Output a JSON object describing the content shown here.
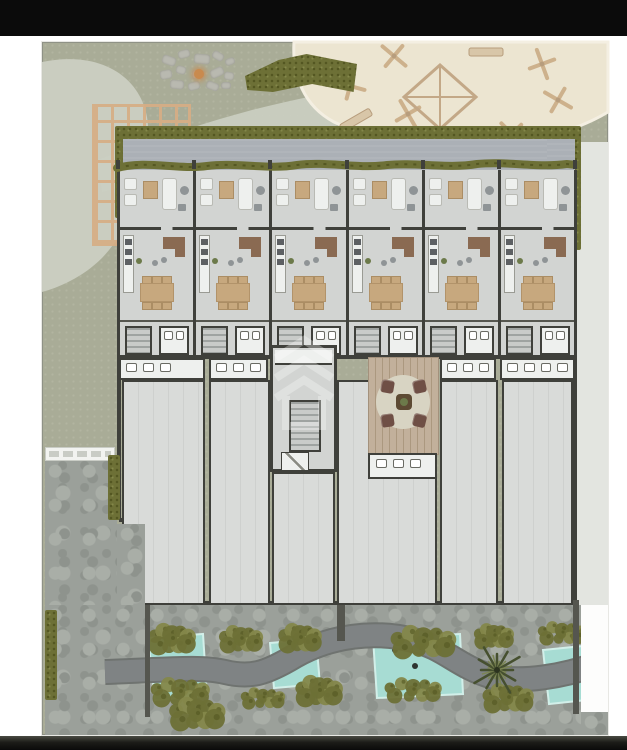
{
  "meta": {
    "description": "Rendered architectural ground-floor site plan: six row-house units with furnished interiors, a central stair core, courtyard deck with seating, large lower flex rooms, playground sand area, pergola, fire pit, hedges, stone paving and a water garden. No visible text; black letterbox bars top and bottom."
  },
  "palette": {
    "letterbox": "#0b0b0b",
    "page_bg": "#ffffff",
    "ground": "#a9ac97",
    "ground_dot": "#b2b5a0",
    "path_light": "#cbcfc2",
    "sand": "#ece5d1",
    "sand_edge": "#f4efe2",
    "equipment": "#cdb18c",
    "stone": "#b9b9b0",
    "fire": "#c98a4e",
    "hedge": "#6d7036",
    "hedge_dark": "#545722",
    "hedge_light": "#84874a",
    "pergola": "#d7ae85",
    "roof": "#abb0b6",
    "floor": "#d2d4d2",
    "floor_lower": "#d9dbd9",
    "wall": "#3f403b",
    "wall_soft": "#55564f",
    "furn_white": "#eef0ee",
    "furn_gray": "#8f9496",
    "wood": "#c7a87e",
    "wood_dark": "#8a6a52",
    "deck": "#c2b09b",
    "deck_line": "#ab987f",
    "rug": "#d8d4c3",
    "chair": "#6f4f45",
    "stone_paving": "#9ba09a",
    "paving_dark": "#8e938d",
    "paving_light": "#a9aea7",
    "water": "#a7dcd3",
    "water_edge": "#d2efe9",
    "garden_path": "#7f8384",
    "garden_path_edge": "#6f7370",
    "palm": "#46502f",
    "palm_light": "#7c8653",
    "pale_strip": "#e3e5e0",
    "walkway": "#f2f3f0",
    "watermark": "rgba(255,255,255,0.3)"
  },
  "building": {
    "upper_units": 6,
    "hedge_posts": 7,
    "lower_rooms": [
      {
        "x": 80,
        "y": 338,
        "w": 83,
        "h": 225
      },
      {
        "x": 167,
        "y": 338,
        "w": 61,
        "h": 225
      },
      {
        "x": 230,
        "y": 430,
        "w": 63,
        "h": 133
      },
      {
        "x": 295,
        "y": 338,
        "w": 100,
        "h": 225
      },
      {
        "x": 398,
        "y": 338,
        "w": 58,
        "h": 225
      },
      {
        "x": 460,
        "y": 338,
        "w": 71,
        "h": 225
      }
    ],
    "bath_segments": [
      {
        "x": 77,
        "w": 86,
        "fixtures": 3
      },
      {
        "x": 167,
        "w": 59,
        "fixtures": 3
      },
      {
        "x": 398,
        "w": 56,
        "fixtures": 3
      },
      {
        "x": 458,
        "w": 75,
        "fixtures": 4
      }
    ]
  },
  "play_equipment": [
    {
      "type": "pinwheel",
      "x": 60,
      "y": 44,
      "rot": 15
    },
    {
      "type": "pinwheel",
      "x": 104,
      "y": 14,
      "rot": 40
    },
    {
      "type": "bench",
      "x": 196,
      "y": 10,
      "rot": 0
    },
    {
      "type": "pinwheel",
      "x": 252,
      "y": 22,
      "rot": 70
    },
    {
      "type": "pinwheel",
      "x": 268,
      "y": 58,
      "rot": 30
    },
    {
      "type": "pinwheel",
      "x": 222,
      "y": 92,
      "rot": 45
    },
    {
      "type": "bench",
      "x": 160,
      "y": 104,
      "rot": 25
    },
    {
      "type": "pinwheel",
      "x": 118,
      "y": 72,
      "rot": 60
    },
    {
      "type": "bench",
      "x": 66,
      "y": 78,
      "rot": -30
    },
    {
      "type": "kite",
      "x": 150,
      "y": 55,
      "rot": 0
    }
  ],
  "fire_pit": {
    "stones": [
      [
        2,
        6,
        14,
        9,
        20
      ],
      [
        18,
        0,
        12,
        8,
        -15
      ],
      [
        34,
        4,
        16,
        10,
        5
      ],
      [
        52,
        2,
        12,
        8,
        30
      ],
      [
        65,
        8,
        10,
        7,
        -20
      ],
      [
        0,
        20,
        12,
        9,
        -10
      ],
      [
        16,
        16,
        10,
        8,
        15
      ],
      [
        32,
        20,
        12,
        9,
        0
      ],
      [
        50,
        18,
        14,
        9,
        -25
      ],
      [
        64,
        22,
        10,
        8,
        10
      ],
      [
        10,
        30,
        14,
        9,
        5
      ],
      [
        28,
        32,
        12,
        8,
        -15
      ],
      [
        46,
        32,
        13,
        8,
        20
      ],
      [
        61,
        32,
        10,
        7,
        0
      ]
    ],
    "ember": [
      34,
      19
    ]
  },
  "garden": {
    "ponds": [
      {
        "pts": "3,12 58,8 62,70 10,74"
      },
      {
        "pts": "125,17 171,13 175,58 129,62"
      },
      {
        "pts": "228,12 315,8 318,68 232,72"
      },
      {
        "pts": "398,24 438,20 442,74 404,78"
      }
    ],
    "pond_dots": [
      [
        30,
        42
      ],
      [
        148,
        38
      ],
      [
        270,
        40
      ],
      [
        420,
        50
      ],
      [
        250,
        24
      ]
    ],
    "bushes": [
      {
        "x": 5,
        "y": -2,
        "w": 42,
        "h": 32
      },
      {
        "x": 75,
        "y": 0,
        "w": 40,
        "h": 28
      },
      {
        "x": 135,
        "y": -2,
        "w": 38,
        "h": 30
      },
      {
        "x": 245,
        "y": 0,
        "w": 64,
        "h": 34
      },
      {
        "x": 330,
        "y": -2,
        "w": 36,
        "h": 26
      },
      {
        "x": 392,
        "y": -4,
        "w": 48,
        "h": 24
      },
      {
        "x": 5,
        "y": 52,
        "w": 58,
        "h": 30
      },
      {
        "x": 95,
        "y": 62,
        "w": 44,
        "h": 22
      },
      {
        "x": 152,
        "y": 50,
        "w": 42,
        "h": 32
      },
      {
        "x": 238,
        "y": 52,
        "w": 58,
        "h": 26
      },
      {
        "x": 338,
        "y": 58,
        "w": 48,
        "h": 30
      },
      {
        "x": 25,
        "y": 72,
        "w": 52,
        "h": 34
      }
    ],
    "path_d": "M-40,46 C20,44 55,40 80,46 C105,52 120,48 150,30 C185,10 230,4 268,14 C300,22 312,40 345,50 C375,58 420,50 452,38",
    "palm": {
      "x": 352,
      "y": 44,
      "fronds": 12
    }
  },
  "courtyard": {
    "chairs": 4,
    "rug_diameter": 54
  },
  "watermark": {
    "motif": "stacked-chevron building logo"
  }
}
